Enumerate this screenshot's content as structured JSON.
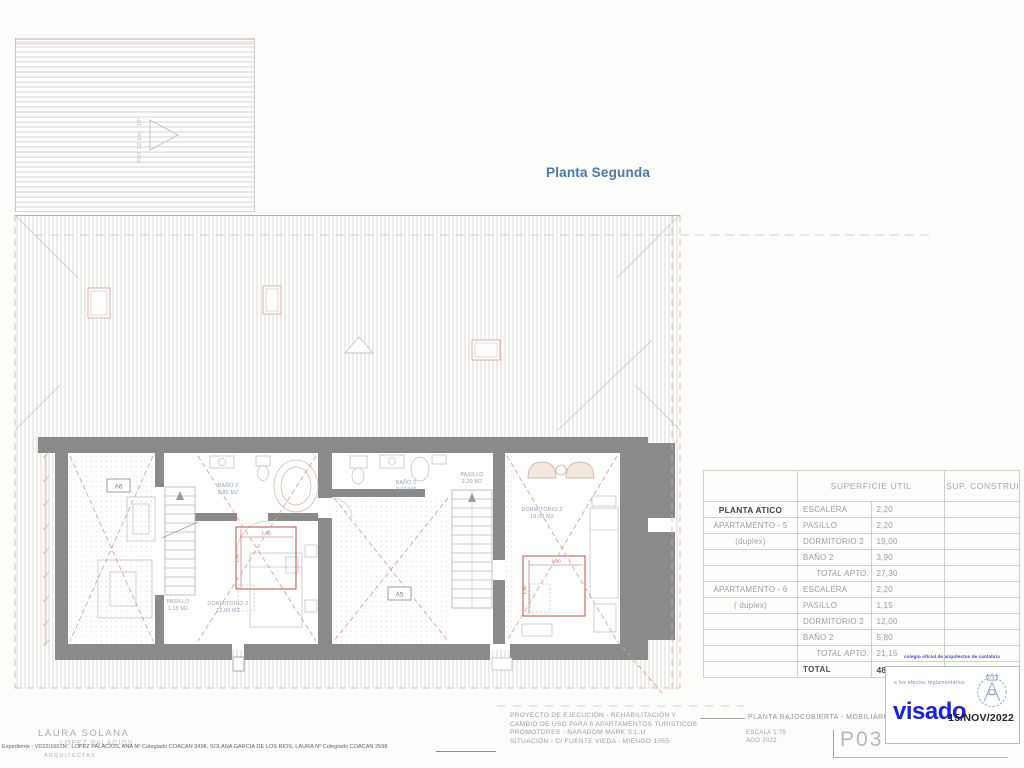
{
  "title": "Planta Segunda",
  "plan": {
    "pitch_label": "PDT 32,6% - 18°",
    "apartment_tags": {
      "a6": "A6",
      "a5": "A5"
    },
    "rooms": [
      {
        "name": "BAÑO 2",
        "area": "5,80 M2"
      },
      {
        "name": "DORMITORIO 2",
        "area": "12,00 M2"
      },
      {
        "name": "PASILLO",
        "area": "1,15 M2"
      },
      {
        "name": "BAÑO 2",
        "area": "3,90 M2"
      },
      {
        "name": "PASILLO",
        "area": "2,20 M2"
      },
      {
        "name": "DORMITORIO 2",
        "area": "19,00 M2"
      }
    ],
    "dimensions": {
      "bed_width": "1,80",
      "bed_depth": "1,80"
    }
  },
  "table": {
    "headers": {
      "superficie": "SUPERFICIE ÚTIL",
      "construida": "SUP. CONSTRUIDA"
    },
    "rows": [
      {
        "group": "PLANTA ATICO",
        "concept": "ESCALERA",
        "util": "2,20",
        "construida": ""
      },
      {
        "group": "APARTAMENTO - 5",
        "concept": "PASILLO",
        "util": "2,20",
        "construida": ""
      },
      {
        "group": "(duplex)",
        "concept": "DORMITORIO 2",
        "util": "19,00",
        "construida": ""
      },
      {
        "group": "",
        "concept": "BAÑO 2",
        "util": "3,90",
        "construida": ""
      },
      {
        "group": "",
        "concept": "TOTAL APTO. 6 (Atico)",
        "util": "27,30",
        "construida": ""
      },
      {
        "group": "APARTAMENTO - 6",
        "concept": "ESCALERA",
        "util": "2,20",
        "construida": ""
      },
      {
        "group": "( duplex)",
        "concept": "PASILLO",
        "util": "1,15",
        "construida": ""
      },
      {
        "group": "",
        "concept": "DORMITORIO 2",
        "util": "12,00",
        "construida": ""
      },
      {
        "group": "",
        "concept": "BAÑO 2",
        "util": "5,80",
        "construida": ""
      },
      {
        "group": "",
        "concept": "TOTAL APTO. 3",
        "util": "21,15",
        "construida": ""
      },
      {
        "group": "",
        "concept": "TOTAL",
        "util": "48,45",
        "construida": "91,70"
      }
    ]
  },
  "stamp": {
    "college": "colegio oficial de arquitectos de cantabria",
    "note": "a los efectos reglamentarios",
    "logo": "visado",
    "date": "15/NOV/2022"
  },
  "titleblock": {
    "project_line1": "PROYECTO DE EJECUCIÓN - REHABILITACIÓN Y",
    "project_line2": "CAMBIO DE USO PARA 6 APARTAMENTOS TURISTICOS",
    "project_line3": "PROMOTORES - NARADOM MARK S.L.U",
    "project_line4": "SITUACIÓN - C/ FUENTE VIEDA - MIENGO 1055",
    "sheet_title": "PLANTA BAJOCUBIERTA - MOBILIARIO",
    "scale": "ESCALA 1:75",
    "date": "AGO 2022",
    "sheet_number": "P03",
    "firm_name": "LAURA SOLANA",
    "firm_name2": "LOPEZ PALACIOS",
    "firm_sub": "ARQUITECTAS",
    "expediente": "Expediente : VD22/1601N : LOPEZ PALACIOS, ANA Nº Colegiado COACAN 3498, SOLANA GARCIA DE LOS RIOS, LAURA Nº Colegiado COACAN 2598"
  },
  "colors": {
    "accent_blue": "#4a79a8",
    "visado_blue": "#1b22cf",
    "plan_red": "#b8504f"
  }
}
